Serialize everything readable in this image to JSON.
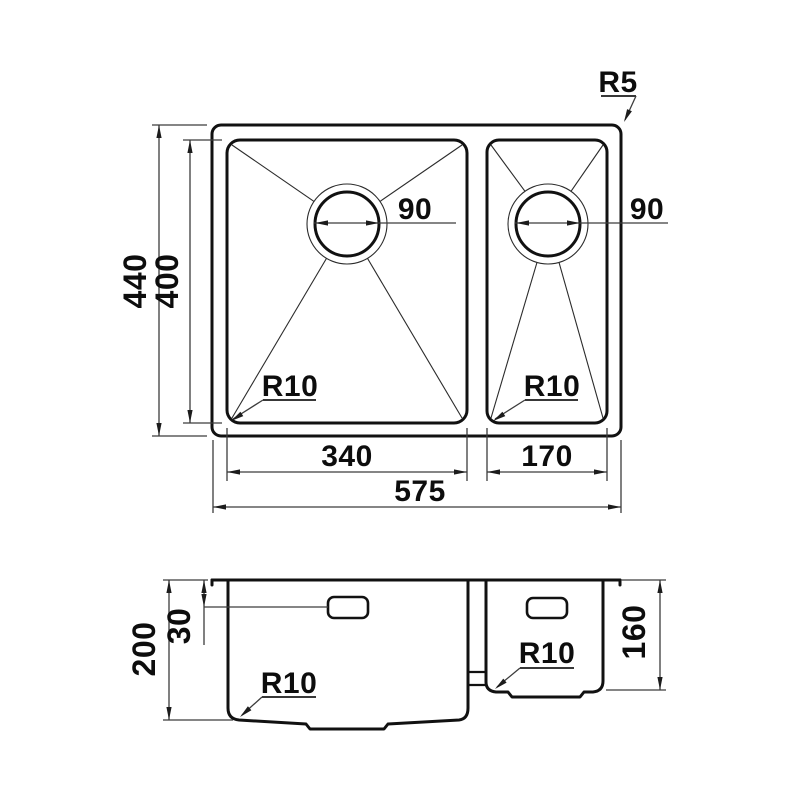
{
  "drawing_title": "sink-dimension-drawing",
  "colors": {
    "object_line": "#111111",
    "dimension_line": "#3c3c3c",
    "text": "#0d0d0d",
    "background": "#ffffff"
  },
  "top_view": {
    "overall_width": "575",
    "overall_depth": "440",
    "bowl_depth": "400",
    "main_bowl_width": "340",
    "small_bowl_width": "170",
    "main_drain_diameter": "90",
    "small_drain_diameter": "90",
    "main_bowl_corner_radius": "R10",
    "small_bowl_corner_radius": "R10",
    "outer_corner_radius": "R5"
  },
  "side_view": {
    "main_bowl_depth": "200",
    "small_bowl_depth": "160",
    "overflow_offset": "30",
    "main_bowl_bottom_radius": "R10",
    "small_bowl_bottom_radius": "R10"
  }
}
